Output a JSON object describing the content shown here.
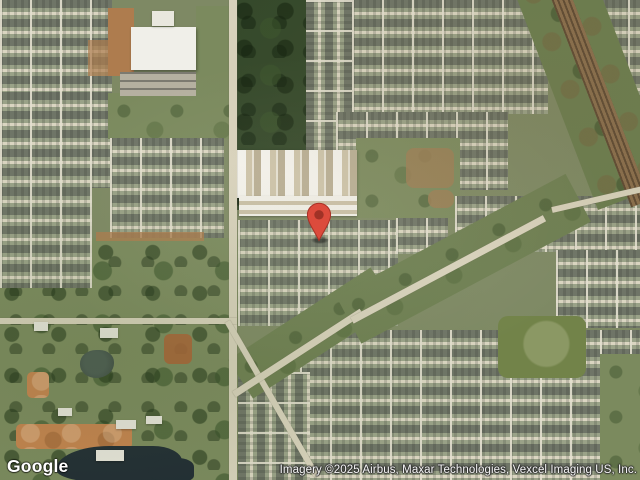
{
  "map": {
    "view_type": "satellite",
    "watermark": "Google",
    "attribution": "Imagery ©2025 Airbus, Maxar Technologies, Vexcel Imaging US, Inc.",
    "marker": {
      "icon": "location-pin-icon",
      "color": "#DC4B3C",
      "stroke_color": "#A93226",
      "inner_color": "#A03226"
    }
  }
}
